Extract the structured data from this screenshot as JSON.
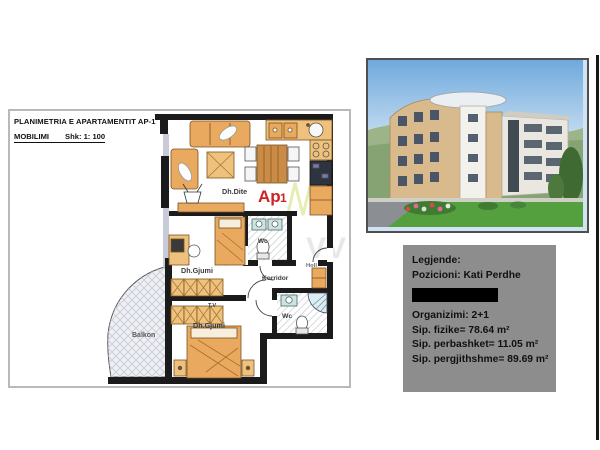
{
  "doc": {
    "title1": "PLANIMETRIA E APARTAMENTIT AP-1",
    "mobilimi": "MOBILIMI",
    "scale": "Shk: 1: 100"
  },
  "rooms": {
    "living": "Dh.Dite",
    "ap_main": "Ap",
    "ap_num": "1",
    "bed1": "Dh.Gjumi",
    "bed2": "Dh.Gjumi",
    "corridor": "Korridor",
    "hall": "Holl",
    "wc1": "Wc",
    "wc2": "Wc",
    "balcony": "Balkon",
    "tv": "T.V"
  },
  "watermark": {
    "f1": "PERI",
    "f2": "VV"
  },
  "legend": {
    "title": "Legjende:",
    "position": "Pozicioni: Kati Perdhe",
    "organization": "Organizimi: 2+1",
    "area1": "Sip. fizike= 78.64 m²",
    "area2": "Sip. perbashket= 11.05 m²",
    "area3": "Sip. pergjithshme= 89.69 m²"
  },
  "colors": {
    "wall": "#1b1b1b",
    "furniture": "#e9a95f",
    "furniture_light": "#eec27c",
    "accent_red": "#cc2222",
    "legend_panel": "#8d8d8d",
    "watermark_green": "#cdd65a"
  }
}
